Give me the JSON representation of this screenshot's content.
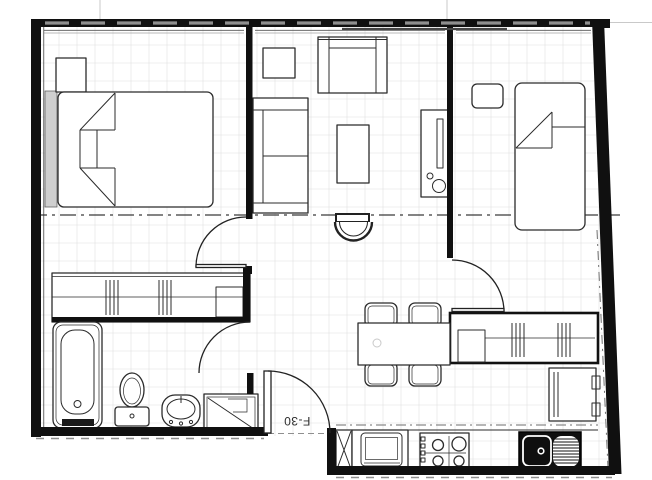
{
  "unit_label": "F-30",
  "colors": {
    "paper": "#ffffff",
    "wall": "#101010",
    "line": "#2b2b2b",
    "muted": "#8f8f8f",
    "grid": "#e0e0e0",
    "accent_dark": "#1a1a1a"
  },
  "plan": {
    "kind": "apartment-floor-plan",
    "rooms": [
      "bedroom-1",
      "living-room",
      "bedroom-2",
      "bathroom",
      "hall-dining",
      "kitchen"
    ]
  },
  "icons": [
    "double-bed-icon",
    "single-bed-icon",
    "nightstand-icon",
    "wardrobe-icon",
    "sofa-icon",
    "loveseat-icon",
    "side-table-icon",
    "coffee-table-icon",
    "tv-console-icon",
    "armchair-icon",
    "dining-table-icon",
    "dining-chair-icon",
    "bathtub-icon",
    "toilet-icon",
    "washbasin-icon",
    "shower-icon",
    "refrigerator-icon",
    "oven-icon",
    "cooktop-icon",
    "kitchen-sink-icon",
    "door-swing-icon",
    "window-icon"
  ]
}
